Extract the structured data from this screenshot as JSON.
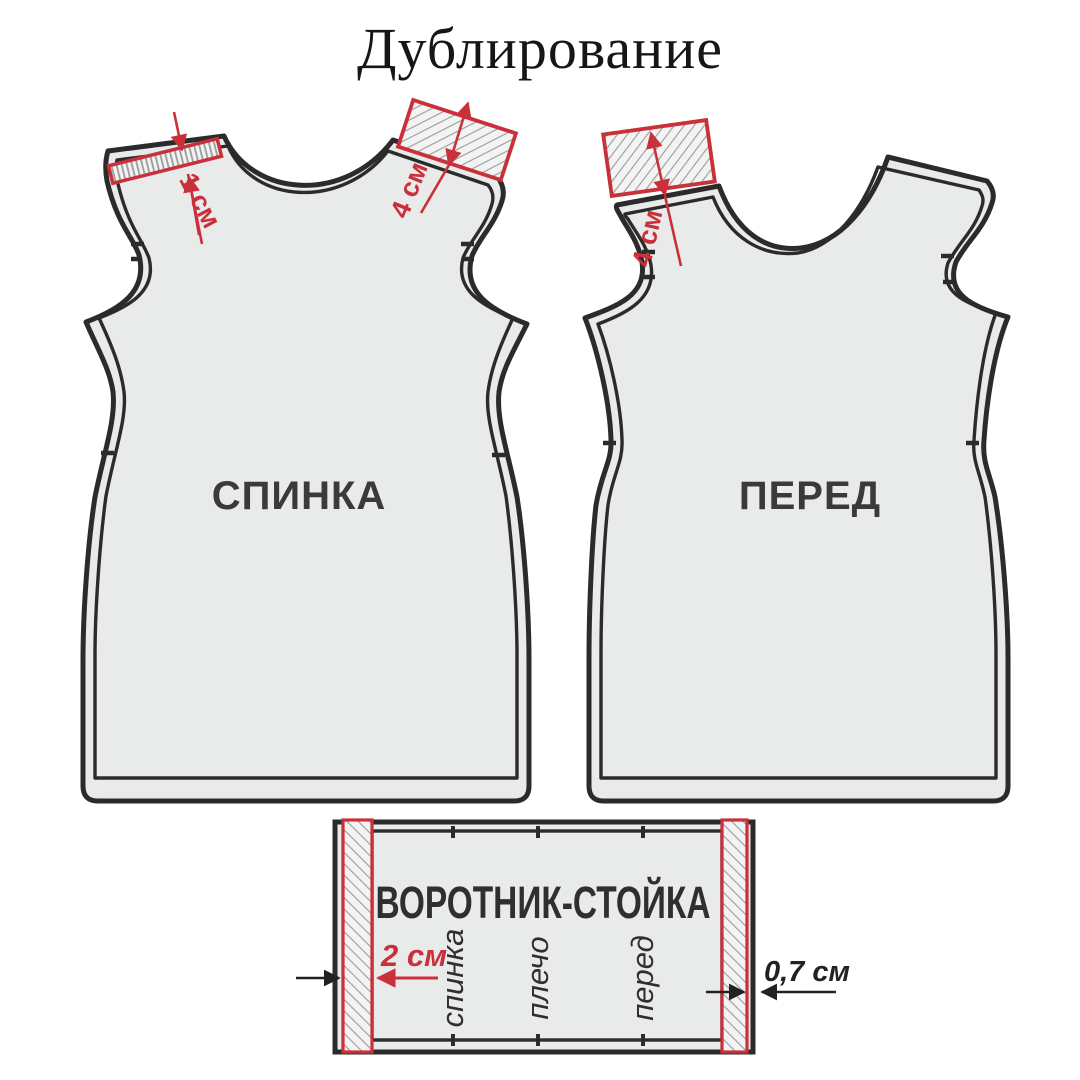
{
  "title": "Дублирование",
  "colors": {
    "red": "#c9303a",
    "outline": "#2b2b2b",
    "piece_fill": "#e9eaea",
    "hatch_line": "#9b9b9b",
    "hatch_bg": "#f3f3f3",
    "label_text": "#3a3a3a",
    "background": "#ffffff"
  },
  "pieces": {
    "back": {
      "label": "СПИНКА",
      "measures": {
        "shoulder_strip": "1 см",
        "shoulder_patch": "4 см"
      }
    },
    "front": {
      "label": "ПЕРЕД",
      "measures": {
        "shoulder_patch": "4 см"
      }
    },
    "collar": {
      "label": "ВОРОТНИК-СТОЙКА",
      "measures": {
        "left_strip": "2 см",
        "right_edge": "0,7 см"
      },
      "match_labels": [
        "спинка",
        "плечо",
        "перед"
      ]
    }
  }
}
